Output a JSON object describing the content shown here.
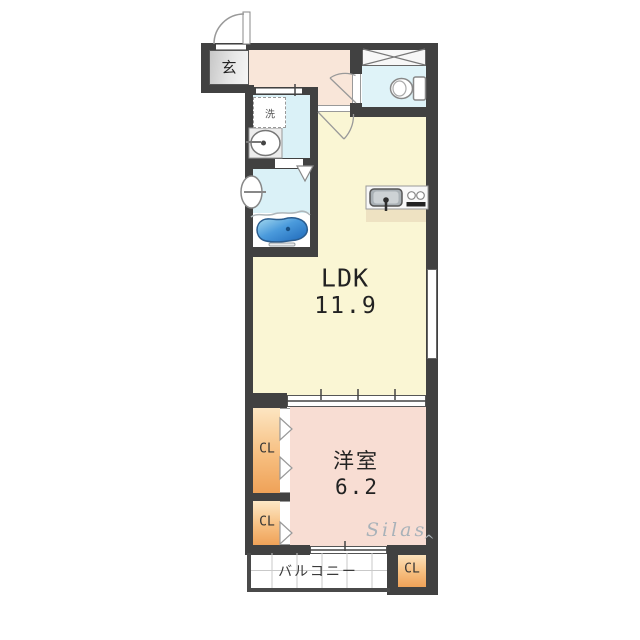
{
  "floorplan": {
    "entrance": {
      "label": "玄"
    },
    "washroom": {
      "washer_label": "洗"
    },
    "ldk": {
      "label": "LDK",
      "size": "11.9"
    },
    "western_room": {
      "label": "洋室",
      "size": "6.2"
    },
    "closets": {
      "cl1": "CL",
      "cl2": "CL",
      "cl3": "CL"
    },
    "balcony": {
      "label": "バルコニー"
    },
    "watermark": {
      "text": "Silas",
      "caret": "^"
    },
    "icons": [
      "entrance-door-arc-icon",
      "toilet-icon",
      "washing-machine-icon",
      "washbasin-icon",
      "shower-mixer-icon",
      "bathtub-icon",
      "kitchen-sink-icon",
      "stove-burners-icon",
      "closet-door-triangle-icon",
      "sliding-window-icon",
      "cross-box-icon"
    ],
    "colors": {
      "wall": "#414141",
      "ldk_fill": "#faf6d4",
      "western_room_fill": "#f8ddd3",
      "corridor_fill": "#f9e6d9",
      "wet_area_fill": "#daf1f7",
      "closet_top": "#fde8c6",
      "closet_bottom": "#efa258",
      "entrance_gray": "#d9d9d9",
      "bathtub_blue": "#2f7fd0",
      "kitchen_shadow": "#eee2c2",
      "watermark_gray": "#a9b2b9"
    }
  }
}
